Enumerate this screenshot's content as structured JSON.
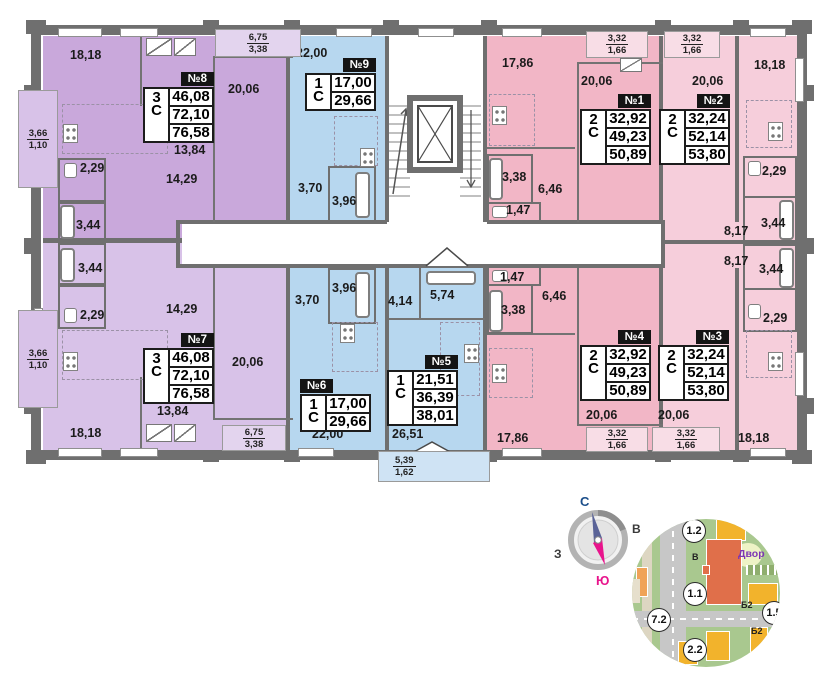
{
  "colors": {
    "wall": "#6f6f6f",
    "purple_dark": "#c9a8db",
    "purple_light": "#d8c2e8",
    "purple_xlight": "#e3d4ee",
    "blue": "#b7d7ef",
    "blue_light": "#cfe3f4",
    "pink_dark": "#f2b6c6",
    "pink_light": "#f6cedb",
    "pink_xlight": "#f8dde6",
    "spec_header_bg": "#141414",
    "compass_north": "#1b4e8a",
    "compass_south": "#e8148c",
    "map_building": "#e06f4a",
    "map_yellow": "#f2b32c"
  },
  "apartments": [
    {
      "id": "№8",
      "rooms": "3",
      "letter": "С",
      "areas": [
        "46,08",
        "72,10",
        "76,58"
      ],
      "x": 143,
      "y": 72,
      "hdr_align": "right"
    },
    {
      "id": "№9",
      "rooms": "1",
      "letter": "С",
      "areas": [
        "17,00",
        "29,66"
      ],
      "x": 305,
      "y": 58,
      "hdr_align": "right"
    },
    {
      "id": "№1",
      "rooms": "2",
      "letter": "С",
      "areas": [
        "32,92",
        "49,23",
        "50,89"
      ],
      "x": 580,
      "y": 94,
      "hdr_align": "right"
    },
    {
      "id": "№2",
      "rooms": "2",
      "letter": "С",
      "areas": [
        "32,24",
        "52,14",
        "53,80"
      ],
      "x": 659,
      "y": 94,
      "hdr_align": "right"
    },
    {
      "id": "№7",
      "rooms": "3",
      "letter": "С",
      "areas": [
        "46,08",
        "72,10",
        "76,58"
      ],
      "x": 143,
      "y": 333,
      "hdr_align": "right"
    },
    {
      "id": "№6",
      "rooms": "1",
      "letter": "С",
      "areas": [
        "17,00",
        "29,66"
      ],
      "x": 300,
      "y": 379,
      "hdr_align": "left"
    },
    {
      "id": "№5",
      "rooms": "1",
      "letter": "С",
      "areas": [
        "21,51",
        "36,39",
        "38,01"
      ],
      "x": 387,
      "y": 355,
      "hdr_align": "right"
    },
    {
      "id": "№4",
      "rooms": "2",
      "letter": "С",
      "areas": [
        "32,92",
        "49,23",
        "50,89"
      ],
      "x": 580,
      "y": 330,
      "hdr_align": "right"
    },
    {
      "id": "№3",
      "rooms": "2",
      "letter": "С",
      "areas": [
        "32,24",
        "52,14",
        "53,80"
      ],
      "x": 658,
      "y": 330,
      "hdr_align": "right"
    }
  ],
  "room_labels": [
    {
      "t": "18,18",
      "x": 70,
      "y": 48
    },
    {
      "t": "20,06",
      "x": 228,
      "y": 82
    },
    {
      "t": "13,84",
      "x": 174,
      "y": 143
    },
    {
      "t": "14,29",
      "x": 166,
      "y": 172
    },
    {
      "t": "2,29",
      "x": 80,
      "y": 161
    },
    {
      "t": "3,44",
      "x": 76,
      "y": 218
    },
    {
      "t": "22,00",
      "x": 296,
      "y": 46
    },
    {
      "t": "3,70",
      "x": 298,
      "y": 181
    },
    {
      "t": "3,96",
      "x": 332,
      "y": 194
    },
    {
      "t": "17,86",
      "x": 502,
      "y": 56
    },
    {
      "t": "20,06",
      "x": 581,
      "y": 74
    },
    {
      "t": "3,38",
      "x": 502,
      "y": 170
    },
    {
      "t": "6,46",
      "x": 538,
      "y": 182
    },
    {
      "t": "1,47",
      "x": 506,
      "y": 203
    },
    {
      "t": "20,06",
      "x": 692,
      "y": 74
    },
    {
      "t": "18,18",
      "x": 754,
      "y": 58
    },
    {
      "t": "2,29",
      "x": 762,
      "y": 164
    },
    {
      "t": "3,44",
      "x": 761,
      "y": 216
    },
    {
      "t": "8,17",
      "x": 724,
      "y": 224
    },
    {
      "t": "3,44",
      "x": 78,
      "y": 261
    },
    {
      "t": "2,29",
      "x": 80,
      "y": 308
    },
    {
      "t": "14,29",
      "x": 166,
      "y": 302
    },
    {
      "t": "20,06",
      "x": 232,
      "y": 355
    },
    {
      "t": "13,84",
      "x": 157,
      "y": 404
    },
    {
      "t": "18,18",
      "x": 70,
      "y": 426
    },
    {
      "t": "3,96",
      "x": 332,
      "y": 281
    },
    {
      "t": "3,70",
      "x": 295,
      "y": 293
    },
    {
      "t": "22,00",
      "x": 312,
      "y": 427
    },
    {
      "t": "4,14",
      "x": 388,
      "y": 294
    },
    {
      "t": "5,74",
      "x": 430,
      "y": 288
    },
    {
      "t": "26,51",
      "x": 392,
      "y": 427
    },
    {
      "t": "1,47",
      "x": 500,
      "y": 270
    },
    {
      "t": "6,46",
      "x": 542,
      "y": 289
    },
    {
      "t": "3,38",
      "x": 501,
      "y": 303
    },
    {
      "t": "17,86",
      "x": 497,
      "y": 431
    },
    {
      "t": "20,06",
      "x": 586,
      "y": 408
    },
    {
      "t": "8,17",
      "x": 724,
      "y": 254
    },
    {
      "t": "3,44",
      "x": 759,
      "y": 262
    },
    {
      "t": "2,29",
      "x": 763,
      "y": 311
    },
    {
      "t": "20,06",
      "x": 658,
      "y": 408
    },
    {
      "t": "18,18",
      "x": 738,
      "y": 431
    }
  ],
  "balconies": [
    {
      "num": "3,66",
      "den": "1,10",
      "x": 18,
      "y": 90,
      "w": 40,
      "h": 98,
      "fill": "purple_light"
    },
    {
      "num": "3,66",
      "den": "1,10",
      "x": 18,
      "y": 310,
      "w": 40,
      "h": 98,
      "fill": "purple_light"
    },
    {
      "num": "6,75",
      "den": "3,38",
      "x": 215,
      "y": 29,
      "w": 86,
      "h": 28,
      "fill": "purple_xlight"
    },
    {
      "num": "6,75",
      "den": "3,38",
      "x": 222,
      "y": 425,
      "w": 64,
      "h": 26,
      "fill": "purple_xlight"
    },
    {
      "num": "3,32",
      "den": "1,66",
      "x": 586,
      "y": 31,
      "w": 62,
      "h": 27,
      "fill": "pink_xlight"
    },
    {
      "num": "3,32",
      "den": "1,66",
      "x": 664,
      "y": 31,
      "w": 56,
      "h": 27,
      "fill": "pink_xlight"
    },
    {
      "num": "3,32",
      "den": "1,66",
      "x": 586,
      "y": 427,
      "w": 62,
      "h": 25,
      "fill": "pink_xlight"
    },
    {
      "num": "3,32",
      "den": "1,66",
      "x": 652,
      "y": 427,
      "w": 68,
      "h": 25,
      "fill": "pink_xlight"
    },
    {
      "num": "5,39",
      "den": "1,62",
      "x": 378,
      "y": 451,
      "w": 112,
      "h": 31,
      "fill": "blue_light"
    }
  ],
  "compass": {
    "north": "С",
    "east": "В",
    "south": "Ю",
    "west": "З"
  },
  "minimap": {
    "plot_circles": [
      {
        "t": "1.2",
        "x": 50,
        "y": 0
      },
      {
        "t": "1.1",
        "x": 51,
        "y": 63
      },
      {
        "t": "7.2",
        "x": 15,
        "y": 89
      },
      {
        "t": "2.2",
        "x": 51,
        "y": 119
      },
      {
        "t": "1.5",
        "x": 130,
        "y": 82
      }
    ],
    "small_labels": [
      {
        "t": "Б2",
        "x": 109,
        "y": 81
      },
      {
        "t": "Б2",
        "x": 119,
        "y": 107
      },
      {
        "t": "В",
        "x": 60,
        "y": 33
      }
    ],
    "yard_label": {
      "t": "Двор",
      "x": 106,
      "y": 29
    }
  }
}
